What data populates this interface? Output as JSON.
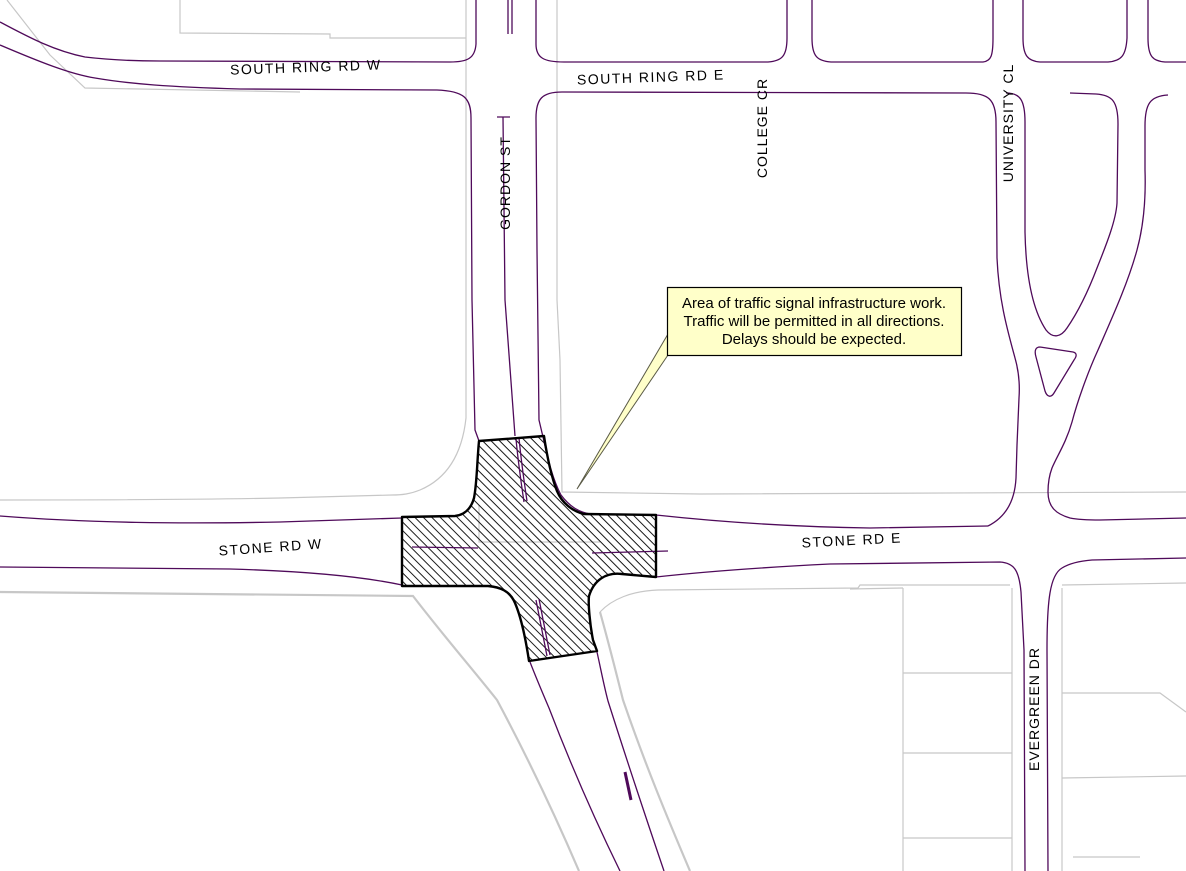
{
  "labels": {
    "south_ring_rd_w": "SOUTH RING RD W",
    "south_ring_rd_e": "SOUTH RING RD E",
    "gordon_st": "GORDON ST",
    "college_cr": "COLLEGE CR",
    "university_cl": "UNIVERSITY CL",
    "stone_rd_w": "STONE RD W",
    "stone_rd_e": "STONE RD E",
    "evergreen_dr": "EVERGREEN DR"
  },
  "callout": {
    "lines": [
      "Area of traffic signal infrastructure work.",
      "Traffic will be permitted in all directions.",
      "Delays should be expected."
    ]
  },
  "colors": {
    "background": "#ffffff",
    "road": "#4f0a5a",
    "parcel": "#c7c7c7",
    "hatch_outline": "#000000",
    "hatch_line": "#000000",
    "callout_fill": "#ffffc9",
    "callout_border": "#000000",
    "label": "#000000"
  }
}
